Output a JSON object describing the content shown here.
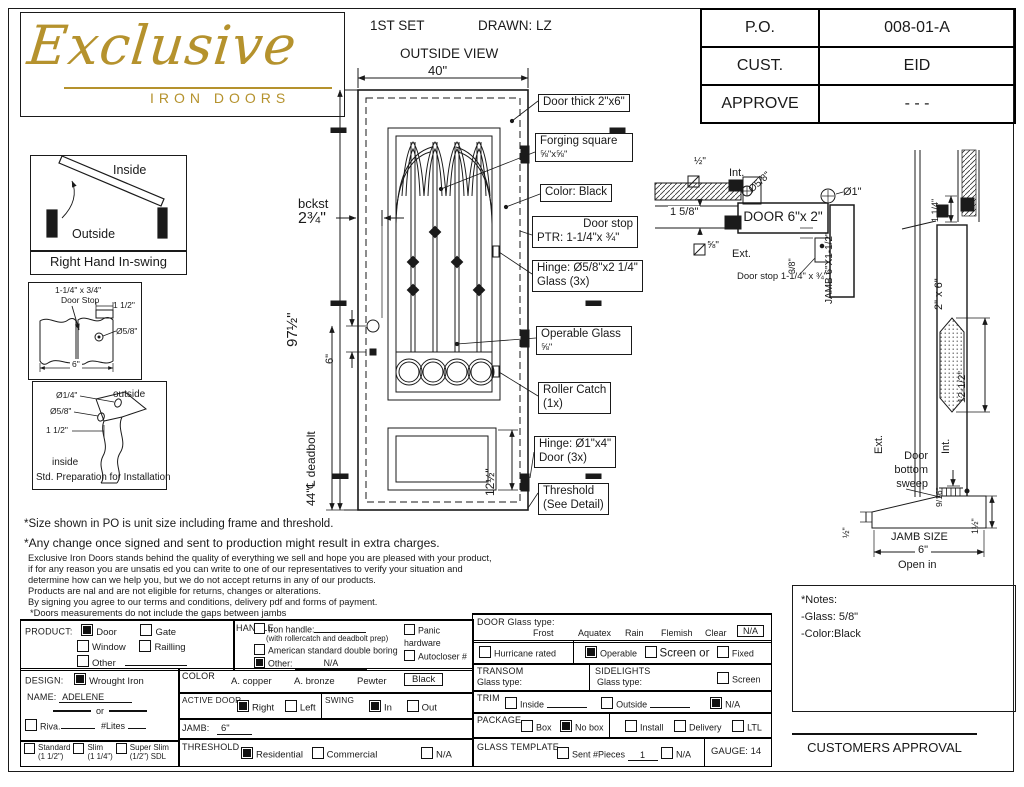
{
  "colors": {
    "gold": "#b5922d",
    "ink": "#1a1a1a"
  },
  "logo": {
    "name": "Exclusive",
    "tagline": "IRON DOORS"
  },
  "header": {
    "set": "1ST SET",
    "drawn": "DRAWN: LZ",
    "view": "OUTSIDE VIEW"
  },
  "po_table": [
    {
      "label": "P.O.",
      "value": "008-01-A"
    },
    {
      "label": "CUST.",
      "value": "EID"
    },
    {
      "label": "APPROVE",
      "value": "- - -"
    }
  ],
  "swing_diagram": {
    "inside": "Inside",
    "outside": "Outside",
    "caption": "Right Hand In-swing"
  },
  "doorstop_diagram": {
    "callout1": "1-1/4\" x 3/4\"",
    "callout2": "Door Stop",
    "width_dim": "1 1/2\"",
    "hole_dim": "Ø5/8\"",
    "base_dim": "6\""
  },
  "prep_diagram": {
    "hole_small": "Ø1/4\"",
    "hole_large": "Ø5/8\"",
    "offset": "1 1/2\"",
    "outside": "outside",
    "inside": "inside",
    "caption": "Std. Preparation for Installation"
  },
  "door_view": {
    "width_dim": "40\"",
    "height_dim": "97½\"",
    "backset_label": "bckst",
    "backset_dim": "2¾\"",
    "knob_gap_dim": "6\"",
    "deadbolt_dim": "44\"℄ deadbolt",
    "panel_dim": "12½\"",
    "callouts": {
      "thick": "Door thick 2\"x6\"",
      "forging1": "Forging square",
      "forging2": "⅝\"x⅝\"",
      "color": "Color: Black",
      "stop1": "Door stop",
      "stop2": "PTR: 1-1/4\"x ¾\"",
      "hinge_glass1": "Hinge: Ø5/8\"x2 1/4\"",
      "hinge_glass2": "Glass (3x)",
      "operable1": "Operable Glass",
      "operable2": "⅝\"",
      "roller1": "Roller Catch",
      "roller2": "(1x)",
      "hinge_door1": "Hinge: Ø1\"x4\"",
      "hinge_door2": "Door (3x)",
      "threshold1": "Threshold",
      "threshold2": "(See Detail)"
    }
  },
  "plan_section": {
    "half": "½\"",
    "int": "Int.",
    "hinge_dia": "Ø5/8\"",
    "knob_dia": "Ø1\"",
    "wall_dim": "1 5/8\"",
    "door_label": "DOOR 6\"x 2\"",
    "five8": "⅝\"",
    "ext": "Ext.",
    "stop_gap": "3/8\"",
    "stop_note": "Door stop 1-1/4\" x ¾\"",
    "jamb": "JAMB 6\"X1-1/2\""
  },
  "vert_section": {
    "top_dim": "1 1/4\"",
    "leaf": "2\" x 6\"",
    "glass_dim": "12-1/2\"",
    "ext": "Ext.",
    "int": "Int.",
    "sweep1": "Door",
    "sweep2": "bottom",
    "sweep3": "sweep",
    "sweep_dim": "9/16\"",
    "th_dim": "1½\"",
    "lip_dim": "½\"",
    "jamb_size": "JAMB SIZE",
    "jamb_val": "6\"",
    "open": "Open in"
  },
  "disclaimer": {
    "line1": "*Size shown in PO is unit size including frame and threshold.",
    "line2": "*Any change once signed and sent to production might result in extra charges.",
    "body": [
      "Exclusive Iron Doors stands behind the quality of everything we sell and hope you are pleased with your product,",
      "if for any reason you are unsatis ed you can write to one of our representatives to verify your situation and",
      "determine how can we help you, but we do not accept returns in any of our products.",
      "Products are  nal and are not eligible for returns, changes or alterations.",
      "By signing you agree to our terms and conditions, delivery pdf and forms of payment.",
      "*Doors measurements do not include the gaps between jambs"
    ]
  },
  "form": {
    "product": {
      "label": "PRODUCT:",
      "door": {
        "label": "Door",
        "checked": true
      },
      "gate": {
        "label": "Gate",
        "checked": false
      },
      "window": {
        "label": "Window",
        "checked": false
      },
      "railling": {
        "label": "Railling",
        "checked": false
      },
      "other": {
        "label": "Other",
        "checked": false
      }
    },
    "design": {
      "label": "DESIGN:",
      "wrought": {
        "label": "Wrought Iron",
        "checked": true
      },
      "name_label": "NAME:",
      "name_value": "ADELENE",
      "or": "or",
      "riva": {
        "label": "Riva.",
        "checked": false
      },
      "lites": "#Lites",
      "standard": {
        "label": "Standard",
        "sub": "(1 1/2\")",
        "checked": false
      },
      "slim": {
        "label": "Slim",
        "sub": "(1 1/4\")",
        "checked": false
      },
      "super_slim": {
        "label": "Super Slim",
        "sub": "(1/2\") SDL",
        "checked": false
      }
    },
    "handle": {
      "label": "HANDLE",
      "iron": {
        "label": "Iron handle:",
        "checked": false
      },
      "iron_note": "(with rollercatch and deadbolt prep)",
      "american": {
        "label": "American standard double boring",
        "checked": false
      },
      "other": {
        "label": "Other:",
        "value": "N/A",
        "checked": true
      },
      "panic": {
        "label": "Panic hardware",
        "checked": false
      },
      "autocloser": {
        "label": "Autocloser #",
        "checked": false
      },
      "pbar": {
        "label": "P. Bar #",
        "checked": false
      }
    },
    "color": {
      "label": "COLOR",
      "opt1": "A. copper",
      "opt2": "A. bronze",
      "opt3": "Pewter",
      "selected": "Black"
    },
    "active_door": {
      "label": "ACTIVE DOOR",
      "right": {
        "label": "Right",
        "checked": true
      },
      "left": {
        "label": "Left",
        "checked": false
      }
    },
    "swing": {
      "label": "SWING",
      "in": {
        "label": "In",
        "checked": true
      },
      "out": {
        "label": "Out",
        "checked": false
      }
    },
    "jamb": {
      "label": "JAMB:",
      "value": "6\""
    },
    "threshold": {
      "label": "THRESHOLD",
      "residential": {
        "label": "Residential",
        "checked": true
      },
      "commercial": {
        "label": "Commercial",
        "checked": false
      },
      "na": {
        "label": "N/A",
        "checked": false
      }
    },
    "glass": {
      "label": "DOOR Glass type:",
      "opt1": "Frost",
      "opt2": "Aquatex",
      "opt3": "Rain",
      "opt4": "Flemish",
      "opt5": "Clear",
      "selected": "N/A",
      "hurricane": {
        "label": "Hurricane rated",
        "checked": false
      },
      "operable": {
        "label": "Operable",
        "checked": true
      },
      "screen": {
        "label": "Screen or",
        "checked": false
      },
      "fixed": {
        "label": "Fixed",
        "checked": false
      }
    },
    "transom": {
      "label": "TRANSOM",
      "glass_label": "Glass type:"
    },
    "sidelights": {
      "label": "SIDELIGHTS",
      "glass_label": "Glass type:",
      "screen": {
        "label": "Screen",
        "checked": false
      }
    },
    "trim": {
      "label": "TRIM",
      "inside": {
        "label": "Inside",
        "checked": false
      },
      "outside": {
        "label": "Outside",
        "checked": false
      },
      "na": {
        "label": "N/A",
        "checked": true
      }
    },
    "package": {
      "label": "PACKAGE",
      "box": {
        "label": "Box",
        "checked": false
      },
      "nobox": {
        "label": "No box",
        "checked": true
      },
      "install": {
        "label": "Install",
        "checked": false
      },
      "delivery": {
        "label": "Delivery",
        "checked": false
      },
      "ltl": {
        "label": "LTL",
        "checked": false
      }
    },
    "template": {
      "label": "GLASS TEMPLATE",
      "sent": {
        "label": "Sent #Pieces",
        "checked": false
      },
      "pieces": "1",
      "na": {
        "label": "N/A",
        "checked": false
      },
      "gauge": "GAUGE: 14"
    }
  },
  "notes_box": {
    "title": "*Notes:",
    "line1": "-Glass: 5/8\"",
    "line2": "-Color:Black"
  },
  "approval": "CUSTOMERS APPROVAL"
}
